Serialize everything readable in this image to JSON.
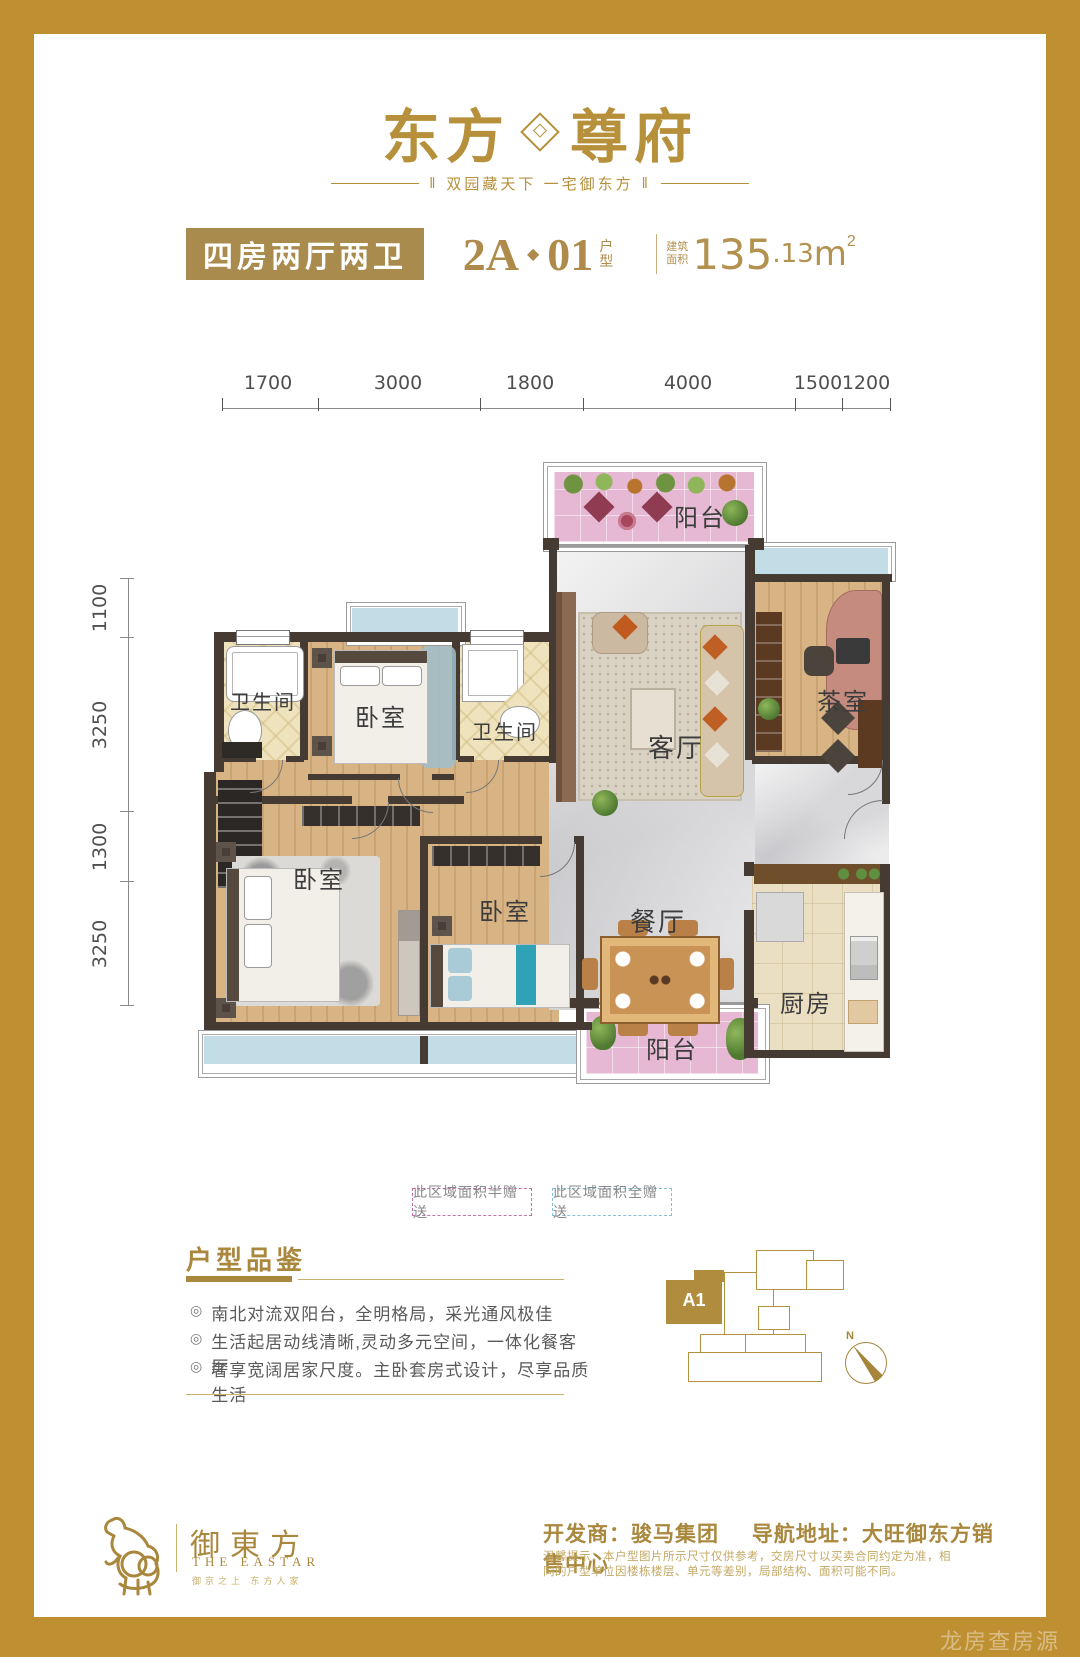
{
  "logo": {
    "brand_left": "东方",
    "brand_right": "尊府",
    "tagline": "双园藏天下  一宅御东方",
    "tagline_deco": "‖"
  },
  "title_bar": {
    "type_label": "四房两厅两卫",
    "unit_code_left": "2A",
    "unit_code_sep": "◆",
    "unit_code_right": "01",
    "unit_suffix_1": "户",
    "unit_suffix_2": "型",
    "area_label_1": "建筑",
    "area_label_2": "面积",
    "area_value": "135",
    "area_decimal": ".13",
    "area_unit": "m",
    "area_sup": "2"
  },
  "dimensions": {
    "top": [
      "1700",
      "3000",
      "1800",
      "4000",
      "1500",
      "1200"
    ],
    "left": [
      "1100",
      "3250",
      "1300",
      "3250"
    ]
  },
  "rooms": {
    "balcony_top": "阳台",
    "bath_1": "卫生间",
    "bedroom_a": "卧室",
    "bath_2": "卫生间",
    "living": "客厅",
    "tea_room": "茶室",
    "bedroom_b": "卧室",
    "bedroom_c": "卧室",
    "dining": "餐厅",
    "kitchen": "厨房",
    "balcony_bottom": "阳台"
  },
  "legend": {
    "half_gift": "此区域面积半赠送",
    "full_gift": "此区域面积全赠送",
    "half_color": "#C473A8",
    "full_color": "#85BFD8"
  },
  "review": {
    "title": "户型品鉴",
    "bullet_glyph": "◎",
    "bullets": [
      "南北对流双阳台，全明格局，采光通风极佳",
      "生活起居动线清晰,灵动多元空间，一体化餐客厅",
      "奢享宽阔居家尺度。主卧套房式设计，尽享品质生活"
    ]
  },
  "keyplan": {
    "unit_label": "A1",
    "compass_n": "N"
  },
  "footer": {
    "brand": "御東方",
    "brand_en": "THE EASTAR",
    "slogan": "御京之上  东方人家",
    "dev_label": "开发商：",
    "dev_value": "骏马集团",
    "nav_label": "导航地址：",
    "nav_value": "大旺御东方销售中心",
    "disclaimer": "温馨提示：本户型图片所示尺寸仅供参考，交房尺寸以买卖合同约定为准，相同的户型单位因楼栋楼层、单元等差别，局部结构、面积可能不同。"
  },
  "watermark": "龙房查房源"
}
